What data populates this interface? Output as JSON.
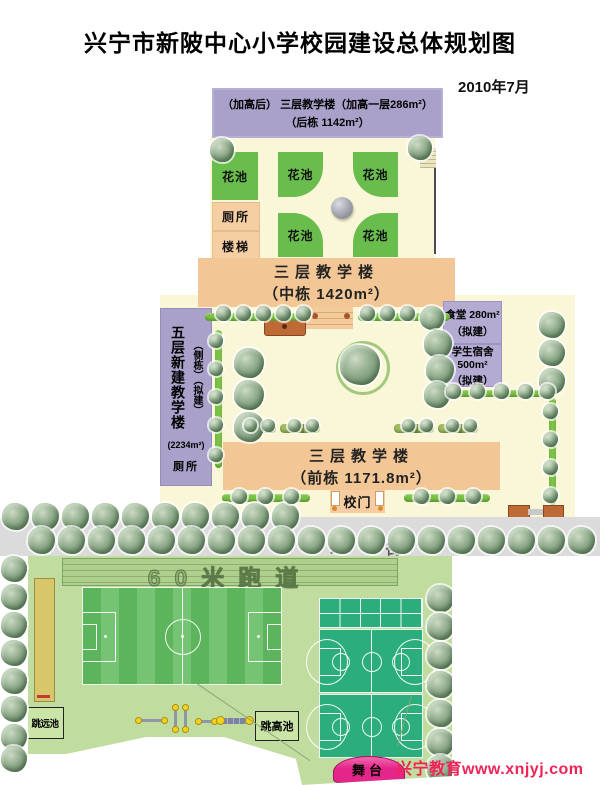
{
  "title": "兴宁市新陂中心小学校园建设总体规划图",
  "date": "2010年7月",
  "watermark": "兴宁教育www.xnjyj.com",
  "buildings": {
    "back": {
      "line1": "（加高后） 三层教学楼（加高一层286m²）",
      "line2": "（后栋  1142m²）"
    },
    "middle": {
      "line1": "三层教学楼",
      "line2": "（中栋 1420m²）"
    },
    "front": {
      "line1": "三层教学楼",
      "line2": "（前栋 1171.8m²）"
    },
    "side": {
      "name": "五层新建教学楼",
      "note": "（侧栋）（拟建）",
      "area": "(2234m²)",
      "toilet": "厕所"
    },
    "canteen": {
      "line1": "食堂 280m²",
      "line2": "（拟建）"
    },
    "dorm": {
      "line1": "学生宿舍 500m²",
      "line2": "（拟建）"
    }
  },
  "garden": {
    "flower_bed": "花池",
    "toilet": "厕所",
    "stairs": "楼梯"
  },
  "site": {
    "gate": "校门",
    "street_left": "大",
    "street_right": "街"
  },
  "sports": {
    "track": "60米跑道",
    "long_jump": "跳远池",
    "high_jump": "跳高池",
    "stage": "舞台"
  },
  "colors": {
    "building_orange": "#F2C795",
    "building_purple": "#A9A1C9",
    "campus_cream": "#FAF7D8",
    "flower_green": "#69BD4D",
    "street_gray": "#DBDBDB",
    "field_green": "#C1DC9F",
    "court_teal": "#2CAD7C",
    "stage_pink": "#E83A92",
    "watermark_red": "#EF2355"
  }
}
